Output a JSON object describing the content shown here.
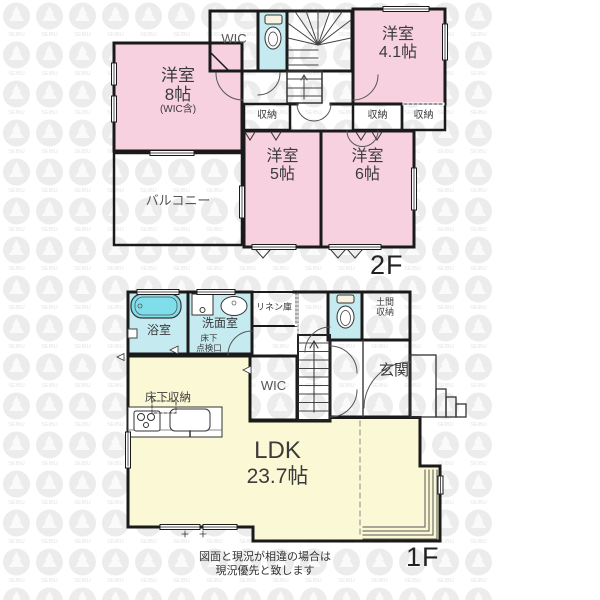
{
  "watermark": {
    "text": "SEIBU"
  },
  "colors": {
    "room_pink": "#f8d1e0",
    "wet_blue": "#c5ebf1",
    "ldk_yellow": "#fbf8d5",
    "tub_cyan": "#7fdeea",
    "wall": "#1a1a1a",
    "watermark_gray": "#ececec"
  },
  "floor2f": {
    "floor_label": "2F",
    "wic": "WIC",
    "room8": {
      "name": "洋室",
      "size": "8帖",
      "note": "(WIC含)"
    },
    "room41": {
      "name": "洋室",
      "size": "4.1帖"
    },
    "room5": {
      "name": "洋室",
      "size": "5帖"
    },
    "room6": {
      "name": "洋室",
      "size": "6帖"
    },
    "balcony": "バルコニー",
    "closet_left": "収納",
    "closet_mid": "収納",
    "closet_right": "収納"
  },
  "floor1f": {
    "floor_label": "1F",
    "bath": "浴室",
    "washroom": "洗面室",
    "linen": "リネン庫",
    "underfloor_hatch_l1": "床下",
    "underfloor_hatch_l2": "点検口",
    "doma_l1": "土間",
    "doma_l2": "収納",
    "entrance": "玄関",
    "wic": "WIC",
    "underfloor_storage": "床下収納",
    "ldk": {
      "name": "LDK",
      "size": "23.7帖"
    }
  },
  "footer": {
    "disclaimer_l1": "図面と現況が相違の場合は",
    "disclaimer_l2": "現況優先と致します"
  }
}
